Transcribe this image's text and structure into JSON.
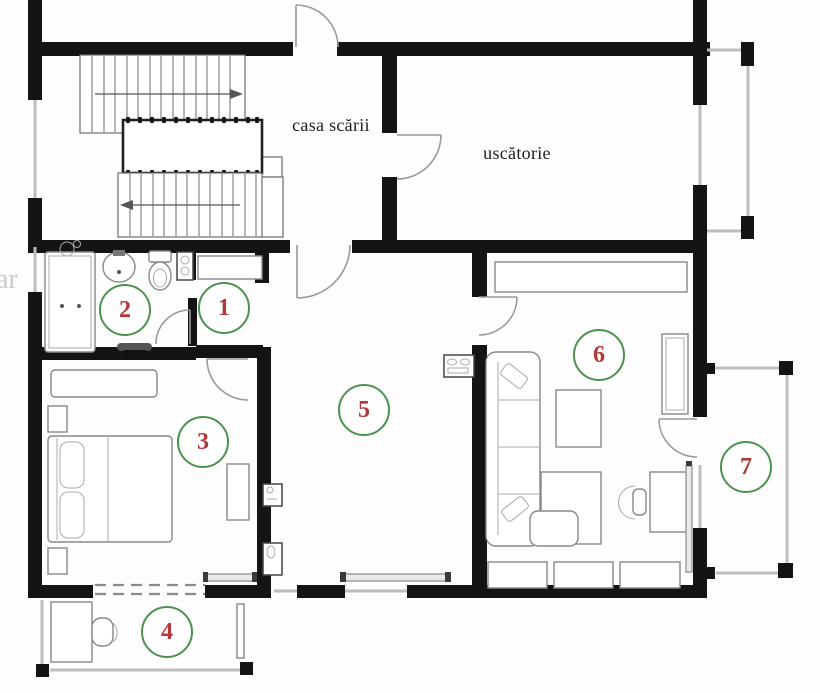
{
  "labels": {
    "staircase": "casa scării",
    "drying_room": "uscătorie"
  },
  "rooms": [
    {
      "number": "1"
    },
    {
      "number": "2"
    },
    {
      "number": "3"
    },
    {
      "number": "4"
    },
    {
      "number": "5"
    },
    {
      "number": "6"
    },
    {
      "number": "7"
    }
  ],
  "watermark": "ar",
  "colors": {
    "wall": "#141414",
    "window": "#bdbdbd",
    "door_stroke": "#9a9a9a",
    "furniture_stroke": "#888888",
    "circle_stroke": "#4d9150",
    "number_color": "#b23737"
  }
}
